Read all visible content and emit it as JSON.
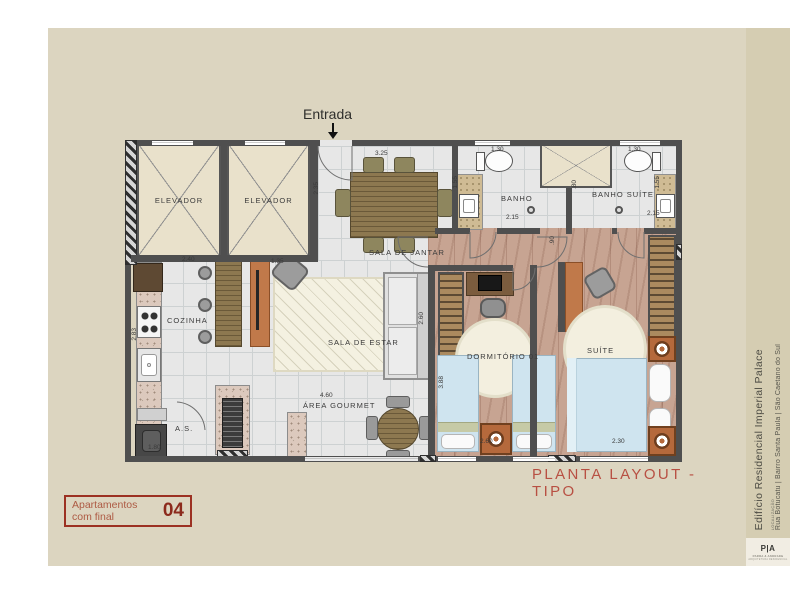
{
  "board": {
    "entrance_label": "Entrada",
    "title": "PLANTA LAYOUT - TIPO"
  },
  "badge": {
    "line1": "Apartamentos",
    "line2": "com final",
    "number": "04"
  },
  "sidebar": {
    "building": "Edifício Residencial Imperial Palace",
    "location_label": "LOCALIZAÇÃO",
    "address": "Rua Botucatu | Bairro Santa Paula | São Caetano do Sul",
    "logo": "P|A",
    "logo_sub": "PARRA & ANDRADE",
    "logo_tagline": "ARQUITETURA RESIDENCIAL"
  },
  "rooms": {
    "elevator1": "ELEVADOR",
    "elevator2": "ELEVADOR",
    "dining": "SALA DE JANTAR",
    "bathroom": "BANHO",
    "bathroom_suite": "BANHO SUÍTE",
    "kitchen": "COZINHA",
    "living": "SALA DE ESTAR",
    "laundry": "A.S.",
    "gourmet": "ÁREA GOURMET",
    "bedroom": "DORMITÓRIO 01",
    "suite": "SUÍTE"
  },
  "dims": {
    "dining_width": "3.25",
    "entry_depth": "2.35",
    "bath_width": "1.30",
    "bath_suite_width": "1.30",
    "bath_depth": "1.55",
    "bath_suite_depth": "1.55",
    "bath_length": "2.15",
    "bath_suite_length": "2.15",
    "shaft_width": ".80",
    "hall_width": ".90",
    "kitchen_width": "2.40",
    "tv_panel_width": "1.35",
    "kitchen_length": "2.83",
    "laundry_width": "1.80",
    "gourmet_length": "4.60",
    "sofa_length": "2.60",
    "bedroom_length": "3.88",
    "bedroom_width": "2.60",
    "suite_width": "2.30"
  },
  "colors": {
    "accent_red": "#b85043",
    "badge_red": "#9c3122",
    "board_bg": "#dcd5c0",
    "sidebar_bg": "#d5cdb2",
    "wall": "#4f4f4f",
    "tile_floor": "#e7e7e7",
    "wood_floor": "#c7a492"
  }
}
